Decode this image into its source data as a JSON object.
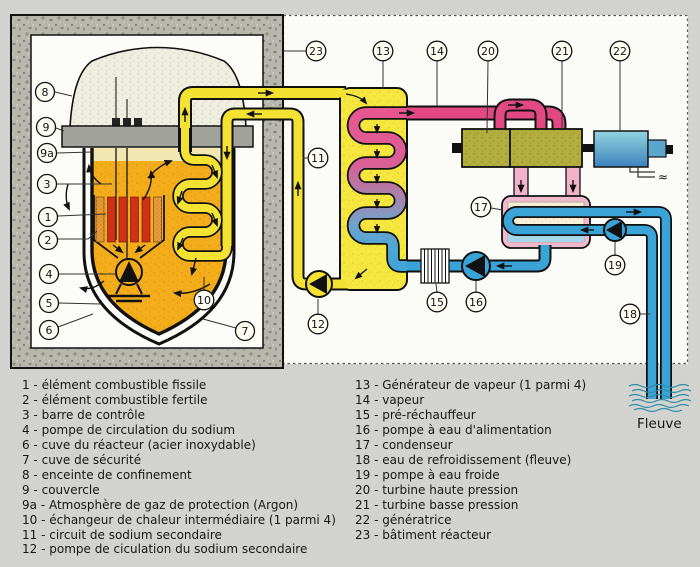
{
  "callouts": {
    "c1": "1",
    "c2": "2",
    "c3": "3",
    "c4": "4",
    "c5": "5",
    "c6": "6",
    "c7": "7",
    "c8": "8",
    "c9": "9",
    "c9a": "9a",
    "c10": "10",
    "c11": "11",
    "c12": "12",
    "c13": "13",
    "c14": "14",
    "c15": "15",
    "c16": "16",
    "c17": "17",
    "c18": "18",
    "c19": "19",
    "c20": "20",
    "c21": "21",
    "c22": "22",
    "c23": "23"
  },
  "legend": {
    "left": [
      "1 - élément combustible fissile",
      "2 - élément combustible fertile",
      "3 - barre de contrôle",
      "4 - pompe de circulation du sodium",
      "6 - cuve du réacteur (acier inoxydable)",
      "7 - cuve de sécurité",
      "8 - enceinte de confinement",
      "9 - couvercle",
      "9a - Atmosphère de gaz de protection (Argon)",
      "10 - échangeur de chaleur intermédiaire (1 parmi 4)",
      "11 - circuit de sodium secondaire",
      "12 - pompe de ciculation du sodium secondaire"
    ],
    "right": [
      "13 - Générateur de vapeur (1 parmi 4)",
      "14 - vapeur",
      "15 - pré-réchauffeur",
      "16 - pompe à eau d'alimentation",
      "17 - condenseur",
      "18 - eau de refroidissement (fleuve)",
      "19 - pompe à eau froide",
      "20 - turbine haute pression",
      "21 - turbine basse pression",
      "22 - génératrice",
      "23 - bâtiment réacteur"
    ]
  },
  "river_label": "Fleuve",
  "generator_output_symbol": "≈",
  "colors": {
    "background": "#d2d2ce",
    "primary_sodium": "#f3ad1b",
    "secondary_sodium": "#f4e233",
    "steam": "#e24983",
    "water": "#3aa3d7",
    "turbine": "#b2ae3e",
    "generator": "#62b8d2",
    "concrete": "#b7b7ae",
    "fissile_rod": "#cf3118",
    "fertile_rod": "#e89b3a"
  }
}
